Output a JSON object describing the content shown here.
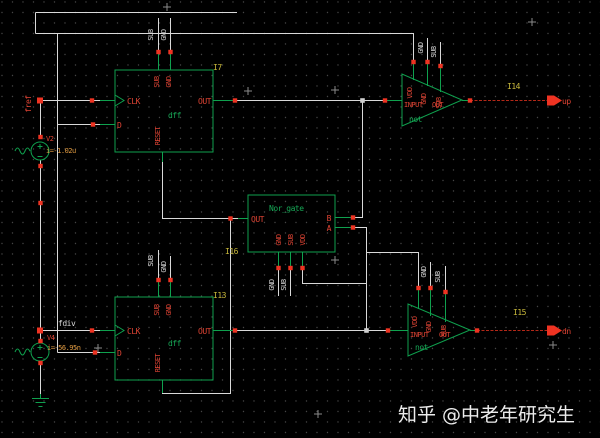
{
  "canvas": {
    "watermark": "知乎 @中老年研究生",
    "background": "#000000"
  },
  "colors": {
    "symbol_green": "#0fa14e",
    "pin_label_red": "#e04434",
    "connection_square_red": "#ee3322",
    "wire_gray": "#d9d9d9",
    "instance_id_yellow": "#c9b93b",
    "param_orange": "#e09a40",
    "signal_wire_red": "#b42818"
  },
  "ports": {
    "fref": "fref",
    "fdiv": "fdiv",
    "up": "up",
    "dn": "dn"
  },
  "instances": {
    "dff_top": {
      "id": "I7",
      "cell": "dff",
      "pins": {
        "clk": "CLK",
        "d": "D",
        "out": "OUT",
        "reset": "RESET",
        "sub": "SUB",
        "gnd": "GND"
      }
    },
    "dff_bottom": {
      "id": "I13",
      "cell": "dff",
      "pins": {
        "clk": "CLK",
        "d": "D",
        "out": "OUT",
        "reset": "RESET",
        "sub": "SUB",
        "gnd": "GND"
      }
    },
    "nor_gate": {
      "id": "I16",
      "cell": "Nor_gate",
      "pins": {
        "out": "OUT",
        "b": "B",
        "a": "A",
        "gnd": "GND",
        "sub": "SUB",
        "vdd": "VDD"
      }
    },
    "inverter_top": {
      "id": "I14",
      "cell": "not",
      "pins": {
        "input": "INPUT",
        "out": "OUT",
        "vdd": "VDD",
        "gnd": "GND",
        "sub": "SUB"
      }
    },
    "inverter_bottom": {
      "id": "I15",
      "cell": "not",
      "pins": {
        "input": "INPUT",
        "out": "OUT",
        "vdd": "VDD",
        "gnd": "GND",
        "sub": "SUB"
      }
    }
  },
  "sources": {
    "v2": {
      "name": "V2",
      "annotation": "i=-1.02u"
    },
    "v4": {
      "name": "V4",
      "annotation": "i=-56.95n"
    }
  },
  "net_labels": {
    "sub": "SUB",
    "gnd": "GND"
  }
}
